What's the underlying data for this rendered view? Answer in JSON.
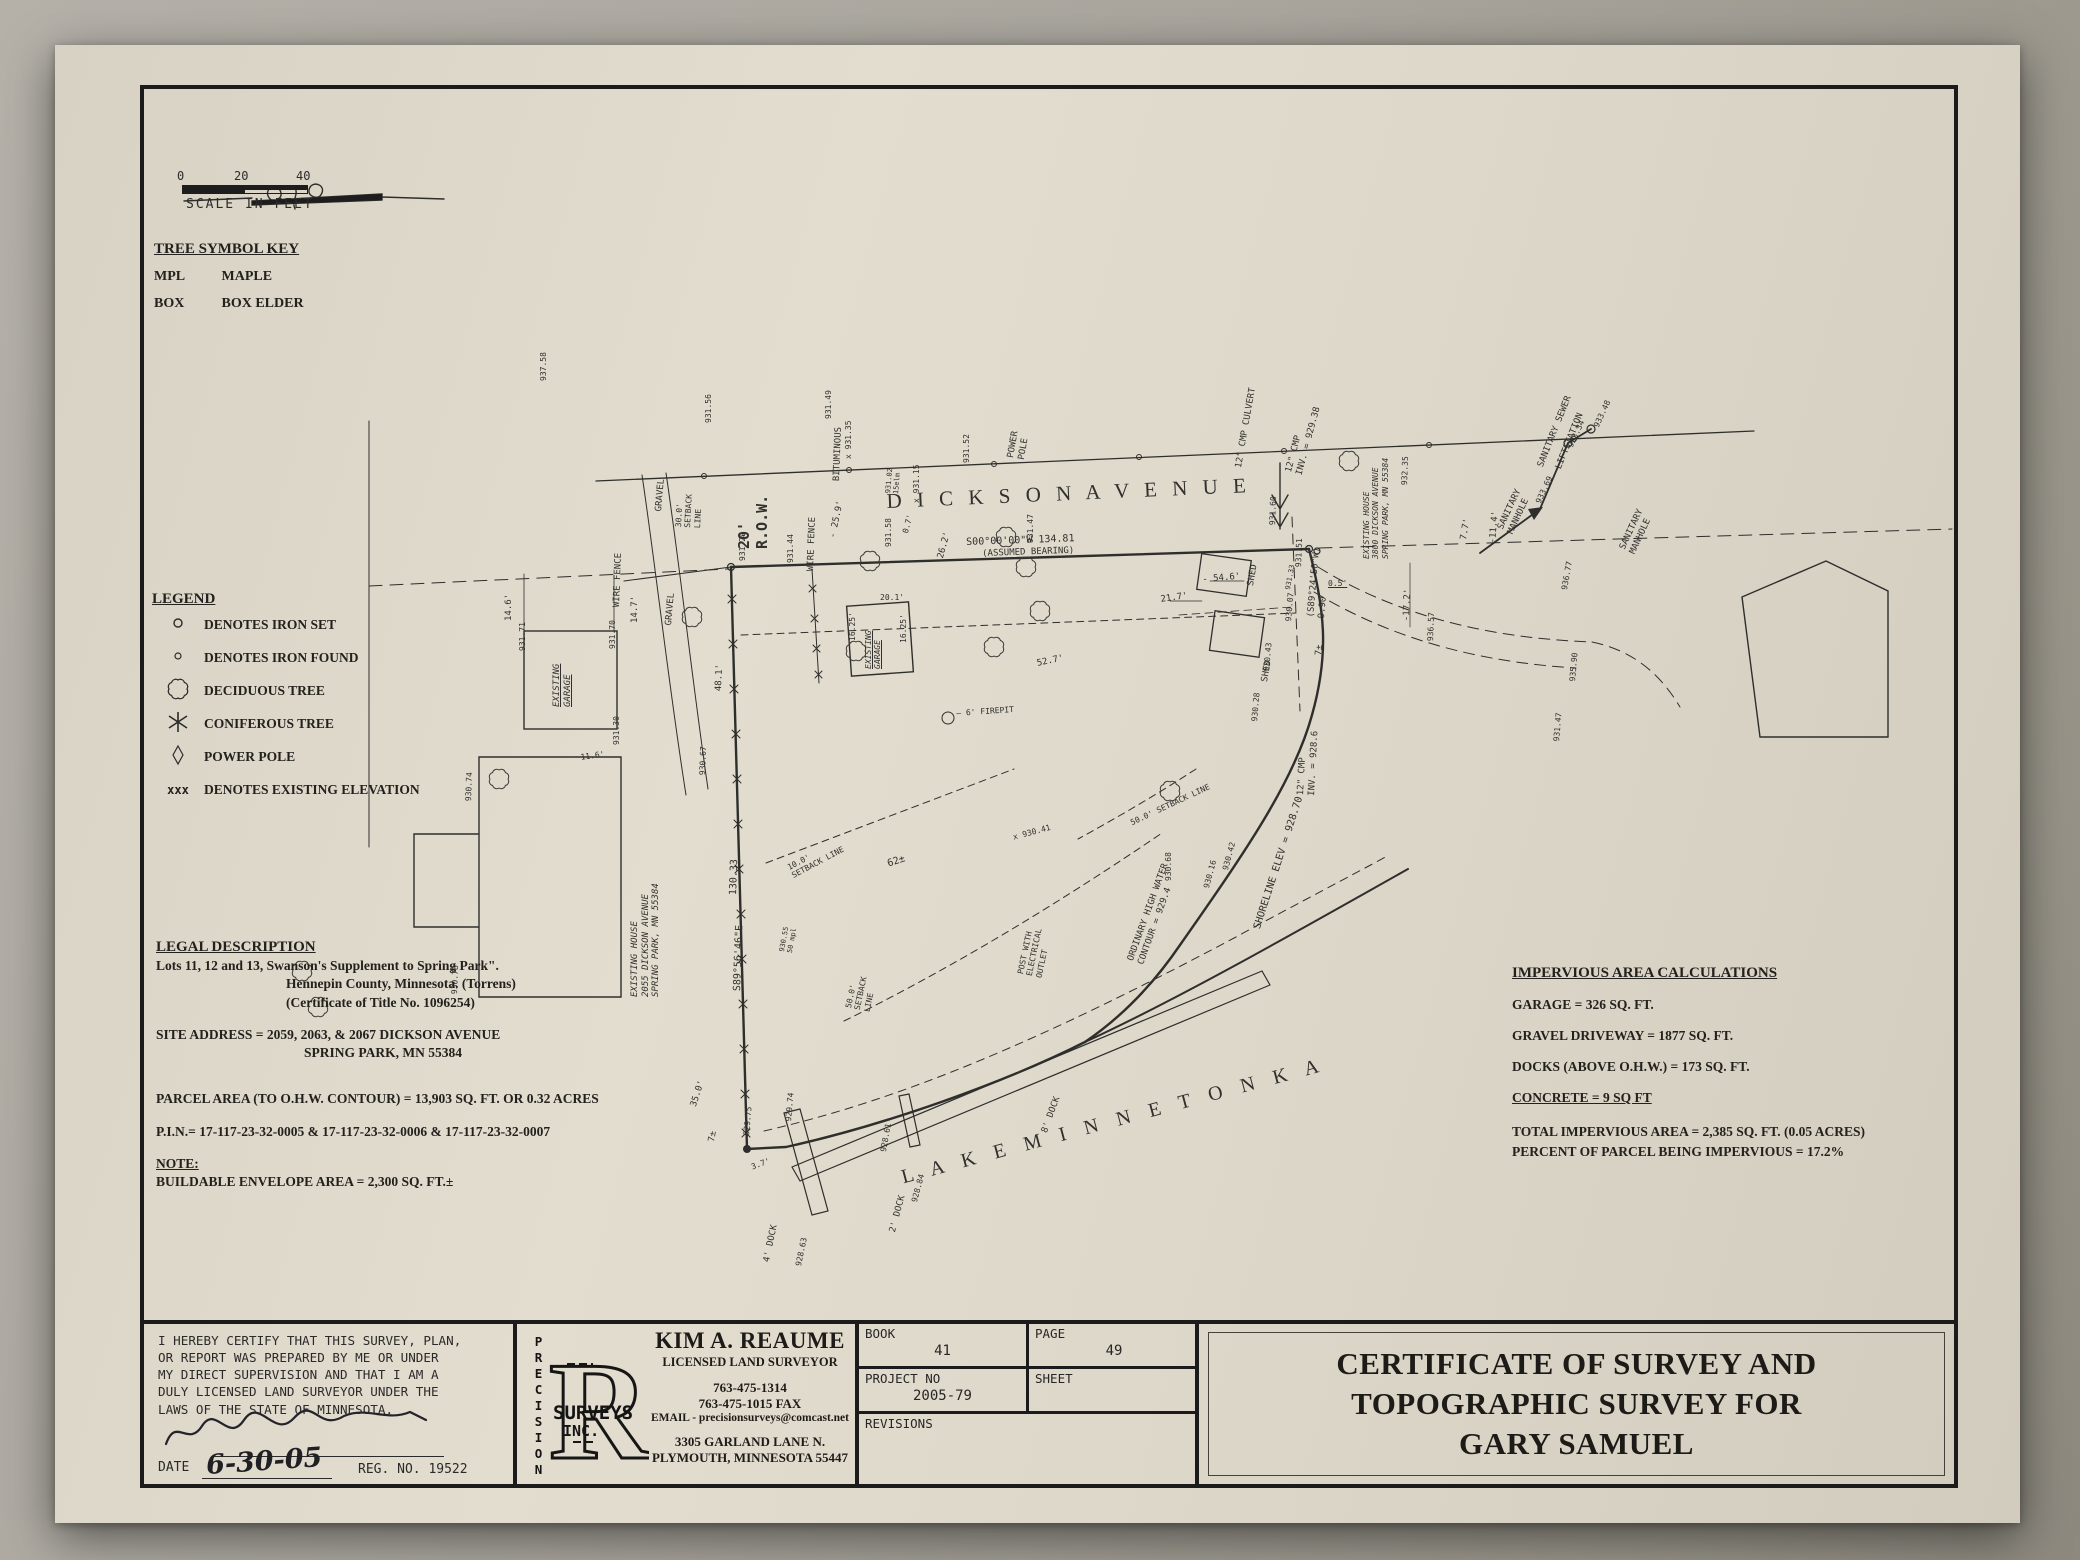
{
  "colors": {
    "paper": "#ded8ca",
    "ink": "#1f1f1f",
    "background": "#a39f97"
  },
  "scale_bar": {
    "tick_0": "0",
    "tick_20": "20",
    "tick_40": "40",
    "caption": "SCALE IN FEET"
  },
  "tree_key": {
    "title": "TREE SYMBOL KEY",
    "rows": [
      {
        "abbr": "MPL",
        "name": "MAPLE"
      },
      {
        "abbr": "BOX",
        "name": "BOX ELDER"
      }
    ]
  },
  "legend": {
    "title": "LEGEND",
    "items": [
      {
        "symbol": "iron-set-circle",
        "label": "DENOTES IRON SET"
      },
      {
        "symbol": "iron-found-circle",
        "label": "DENOTES IRON FOUND"
      },
      {
        "symbol": "deciduous-tree-cloud",
        "label": "DECIDUOUS TREE"
      },
      {
        "symbol": "coniferous-tree-star",
        "label": "CONIFEROUS TREE"
      },
      {
        "symbol": "power-pole-diamond",
        "label": "POWER POLE"
      },
      {
        "symbol": "xxx",
        "label": "DENOTES EXISTING ELEVATION"
      }
    ]
  },
  "legal": {
    "title": "LEGAL DESCRIPTION",
    "line1": "Lots 11, 12 and 13, Swanson's Supplement to Spring Park\".",
    "line2": "Hennepin County, Minnesota. (Torrens)",
    "line3": "(Certificate of Title No. 1096254)",
    "site1": "SITE ADDRESS =  2059, 2063, & 2067 DICKSON AVENUE",
    "site2": "SPRING PARK, MN 55384",
    "parcel": "PARCEL AREA (TO O.H.W. CONTOUR) = 13,903 SQ. FT. OR 0.32 ACRES",
    "pin": "P.I.N.= 17-117-23-32-0005 & 17-117-23-32-0006 & 17-117-23-32-0007",
    "note_title": "NOTE:",
    "note_body": "BUILDABLE ENVELOPE AREA = 2,300 SQ. FT.±"
  },
  "impervious": {
    "title": "IMPERVIOUS AREA CALCULATIONS",
    "garage": "GARAGE =  326 SQ. FT.",
    "gravel": "GRAVEL DRIVEWAY =  1877 SQ. FT.",
    "docks": "DOCKS (ABOVE O.H.W.)  =  173 SQ. FT.",
    "concrete": "CONCRETE = 9 SQ FT",
    "total": "TOTAL IMPERVIOUS AREA = 2,385 SQ. FT. (0.05 ACRES)",
    "percent": "PERCENT OF PARCEL BEING IMPERVIOUS = 17.2%"
  },
  "footer": {
    "certification": {
      "lines": [
        "I HEREBY CERTIFY THAT THIS SURVEY, PLAN,",
        "OR REPORT WAS PREPARED BY ME OR UNDER",
        "MY DIRECT SUPERVISION AND THAT I AM A",
        "DULY LICENSED LAND SURVEYOR UNDER THE",
        "LAWS OF THE STATE OF MINNESOTA."
      ],
      "date_label": "DATE",
      "date_value": "6-30-05",
      "reg": "REG. NO. 19522"
    },
    "logo": {
      "letter": "R",
      "vertical": "PRECISION",
      "word2": "SURVEYS",
      "word3": "INC."
    },
    "surveyor": {
      "name": "KIM A. REAUME",
      "title": "LICENSED LAND SURVEYOR",
      "phone": "763-475-1314",
      "fax": "763-475-1015 FAX",
      "email": "EMAIL - precisionsurveys@comcast.net",
      "addr1": "3305 GARLAND LANE N.",
      "addr2": "PLYMOUTH, MINNESOTA 55447"
    },
    "grid": {
      "book_label": "BOOK",
      "book": "41",
      "page_label": "PAGE",
      "page": "49",
      "project_label": "PROJECT NO",
      "project": "2005-79",
      "sheet_label": "SHEET",
      "sheet": "",
      "revisions_label": "REVISIONS"
    },
    "title_block": {
      "line1": "CERTIFICATE OF SURVEY AND",
      "line2": "TOPOGRAPHIC SURVEY FOR",
      "line3": "GARY SAMUEL"
    }
  },
  "map": {
    "labels": [
      {
        "t": "D I C K S O N   A V E N U E",
        "x": 742,
        "y": 400,
        "r": -2.5,
        "fs": 21,
        "sr": 1,
        "ls": 5,
        "n": "street-name-dickson-avenue"
      },
      {
        "t": "L A K E   M I N N E T O N K A",
        "x": 755,
        "y": 1078,
        "r": -15,
        "fs": 20,
        "sr": 1,
        "ls": 7,
        "n": "lake-name-minnetonka"
      },
      {
        "t": "20'\nR.O.W.",
        "x": 592,
        "y": 460,
        "r": -90,
        "fs": 15,
        "w": 1,
        "n": "row-label"
      },
      {
        "t": "S00°00'00\"W    134.81",
        "x": 822,
        "y": 448,
        "r": -2,
        "fs": 10,
        "n": "bearing-north-line"
      },
      {
        "t": "(ASSUMED BEARING)",
        "x": 838,
        "y": 460,
        "r": -2,
        "fs": 9
      },
      {
        "t": "BITUMINOUS",
        "x": 688,
        "y": 392,
        "r": -88,
        "fs": 9
      },
      {
        "t": "POWER\nPOLE",
        "x": 862,
        "y": 368,
        "r": -80,
        "fs": 9
      },
      {
        "t": "12\" CMP CULVERT",
        "x": 1090,
        "y": 378,
        "r": -80,
        "fs": 9
      },
      {
        "t": "12\" CMP\nINV. = 929.38",
        "x": 1140,
        "y": 382,
        "r": -75,
        "fs": 9
      },
      {
        "t": "932.35",
        "x": 1256,
        "y": 396,
        "r": -88,
        "fs": 8
      },
      {
        "t": "931.60",
        "x": 1124,
        "y": 436,
        "r": -88,
        "fs": 8
      },
      {
        "t": "931.51",
        "x": 1150,
        "y": 478,
        "r": -88,
        "fs": 8
      },
      {
        "t": "(S89°24'50\"W)\n9.90",
        "x": 1162,
        "y": 528,
        "r": -85,
        "fs": 9,
        "n": "bearing-east-corner"
      },
      {
        "t": "0.5'",
        "x": 1184,
        "y": 490,
        "fs": 8,
        "u": 1
      },
      {
        "t": "931.33",
        "x": 1140,
        "y": 500,
        "r": -80,
        "fs": 7
      },
      {
        "t": "7±",
        "x": 1170,
        "y": 566,
        "r": -85,
        "fs": 9
      },
      {
        "t": "12\" CMP\nINV. = 928.6",
        "x": 1152,
        "y": 706,
        "r": -87,
        "fs": 9
      },
      {
        "t": "930.07",
        "x": 1140,
        "y": 532,
        "r": -85,
        "fs": 8
      },
      {
        "t": "930.43",
        "x": 1118,
        "y": 582,
        "r": -85,
        "fs": 8
      },
      {
        "t": "930.28",
        "x": 1106,
        "y": 632,
        "r": -85,
        "fs": 8
      },
      {
        "t": "SANITARY\nMANHOLE",
        "x": 1352,
        "y": 438,
        "r": -65,
        "fs": 9
      },
      {
        "t": "SANITARY SEWER",
        "x": 1392,
        "y": 376,
        "r": -68,
        "fs": 9
      },
      {
        "t": "LIFTSTATION",
        "x": 1410,
        "y": 378,
        "r": -68,
        "fs": 9
      },
      {
        "t": "SANITARY\nMANHOLE",
        "x": 1474,
        "y": 458,
        "r": -65,
        "fs": 9
      },
      {
        "t": "933.69",
        "x": 1390,
        "y": 412,
        "r": -65,
        "fs": 8
      },
      {
        "t": "933.34",
        "x": 1422,
        "y": 356,
        "r": -65,
        "fs": 8
      },
      {
        "t": "933.48",
        "x": 1448,
        "y": 336,
        "r": -65,
        "fs": 8
      },
      {
        "t": "S89°56'46\"E",
        "x": 588,
        "y": 902,
        "r": -88,
        "fs": 10,
        "n": "bearing-west-line"
      },
      {
        "t": "130.33",
        "x": 584,
        "y": 806,
        "r": -88,
        "fs": 10
      },
      {
        "t": "EXISTING\nGARAGE",
        "x": 408,
        "y": 618,
        "r": -90,
        "fs": 9,
        "u": 1,
        "it": 1,
        "n": "existing-garage-label"
      },
      {
        "t": "14.6'",
        "x": 360,
        "y": 532,
        "r": -90,
        "fs": 9
      },
      {
        "t": "14.7'",
        "x": 486,
        "y": 534,
        "r": -90,
        "fs": 9
      },
      {
        "t": "931.71",
        "x": 374,
        "y": 562,
        "r": -90,
        "fs": 8
      },
      {
        "t": "931.70",
        "x": 464,
        "y": 560,
        "r": -90,
        "fs": 8
      },
      {
        "t": "931.30",
        "x": 468,
        "y": 656,
        "r": -90,
        "fs": 8
      },
      {
        "t": "EXISTING HOUSE\n2055 DICKSON AVENUE\nSPRING PARK, MN 55384",
        "x": 486,
        "y": 908,
        "r": -90,
        "fs": 9,
        "it": 1,
        "n": "existing-house-2055-label"
      },
      {
        "t": "48.1'",
        "x": 570,
        "y": 602,
        "r": -88,
        "fs": 9
      },
      {
        "t": "GRAVEL",
        "x": 510,
        "y": 422,
        "r": -85,
        "fs": 9
      },
      {
        "t": "30.0'\nSETBACK\nLINE",
        "x": 530,
        "y": 438,
        "r": -87,
        "fs": 8
      },
      {
        "t": "WIRE FENCE",
        "x": 468,
        "y": 518,
        "r": -88,
        "fs": 9
      },
      {
        "t": "WIRE FENCE",
        "x": 662,
        "y": 482,
        "r": -88,
        "fs": 9
      },
      {
        "t": "GRAVEL",
        "x": 520,
        "y": 536,
        "r": -85,
        "fs": 9
      },
      {
        "t": "- 25.9'",
        "x": 684,
        "y": 448,
        "r": -78,
        "fs": 9
      },
      {
        "t": "0.7'",
        "x": 757,
        "y": 443,
        "r": -75,
        "fs": 8
      },
      {
        "t": "26.2'",
        "x": 792,
        "y": 468,
        "r": -75,
        "fs": 9
      },
      {
        "t": "20.1'",
        "x": 736,
        "y": 504,
        "fs": 8
      },
      {
        "t": "16.25'",
        "x": 704,
        "y": 552,
        "r": -90,
        "fs": 8
      },
      {
        "t": "16.25'",
        "x": 755,
        "y": 554,
        "r": -90,
        "fs": 8
      },
      {
        "t": "EXISTING\nGARAGE",
        "x": 720,
        "y": 580,
        "r": -90,
        "fs": 8,
        "u": 1,
        "it": 1,
        "n": "existing-garage-2-label"
      },
      {
        "t": "52.7'",
        "x": 892,
        "y": 570,
        "r": -12,
        "fs": 9
      },
      {
        "t": "50.0'\nSETBACK\nLINE",
        "x": 700,
        "y": 918,
        "r": -78,
        "fs": 8
      },
      {
        "t": "50.0' SETBACK LINE",
        "x": 985,
        "y": 730,
        "r": -25,
        "fs": 8
      },
      {
        "t": "10.0'\nSETBACK LINE",
        "x": 642,
        "y": 775,
        "r": -28,
        "fs": 8
      },
      {
        "t": "62±",
        "x": 742,
        "y": 770,
        "r": -18,
        "fs": 10
      },
      {
        "t": "— 6' FIREPIT",
        "x": 812,
        "y": 620,
        "r": -4,
        "fs": 8,
        "n": "firepit-label"
      },
      {
        "t": "POST WITH\nELECTRICAL\nOUTLET",
        "x": 872,
        "y": 884,
        "r": -78,
        "fs": 8
      },
      {
        "t": "930.55\n50 mpl",
        "x": 634,
        "y": 862,
        "r": -80,
        "fs": 7
      },
      {
        "t": "ORDINARY HIGH WATER\nCONTOUR = 929.4",
        "x": 982,
        "y": 870,
        "r": -70,
        "fs": 9,
        "n": "ohw-contour-label"
      },
      {
        "t": "SHORELINE ELEV = 928.70",
        "x": 1108,
        "y": 838,
        "r": -72,
        "fs": 10,
        "n": "shoreline-elev-label"
      },
      {
        "t": "4' DOCK",
        "x": 618,
        "y": 1172,
        "r": -78,
        "fs": 9
      },
      {
        "t": "928.63",
        "x": 650,
        "y": 1176,
        "r": -78,
        "fs": 8
      },
      {
        "t": "2' DOCK",
        "x": 744,
        "y": 1142,
        "r": -75,
        "fs": 9
      },
      {
        "t": "928.84",
        "x": 766,
        "y": 1112,
        "r": -75,
        "fs": 8
      },
      {
        "t": "8' DOCK",
        "x": 896,
        "y": 1042,
        "r": -70,
        "fs": 9
      },
      {
        "t": "3.7'",
        "x": 606,
        "y": 1074,
        "r": -20,
        "fs": 8
      },
      {
        "t": "929.74",
        "x": 640,
        "y": 1032,
        "r": -85,
        "fs": 8
      },
      {
        "t": "928.61",
        "x": 735,
        "y": 1062,
        "r": -80,
        "fs": 8
      },
      {
        "t": "930.16",
        "x": 1058,
        "y": 798,
        "r": -75,
        "fs": 8
      },
      {
        "t": "930.42",
        "x": 1077,
        "y": 780,
        "r": -75,
        "fs": 8
      },
      {
        "t": "930.68",
        "x": 1020,
        "y": 792,
        "r": -90,
        "fs": 8
      },
      {
        "t": "x 930.41",
        "x": 868,
        "y": 744,
        "r": -15,
        "fs": 8
      },
      {
        "t": "35.0'",
        "x": 545,
        "y": 1016,
        "r": -72,
        "fs": 9
      },
      {
        "t": "11.6'",
        "x": 436,
        "y": 664,
        "r": -8,
        "fs": 8
      },
      {
        "t": "7±",
        "x": 563,
        "y": 1052,
        "r": -80,
        "fs": 9
      },
      {
        "t": "929.75",
        "x": 598,
        "y": 1046,
        "r": -85,
        "fs": 8
      },
      {
        "t": "930.74",
        "x": 320,
        "y": 712,
        "r": -88,
        "fs": 8
      },
      {
        "t": "930.78",
        "x": 306,
        "y": 905,
        "r": -88,
        "fs": 8
      },
      {
        "t": "930.67",
        "x": 554,
        "y": 686,
        "r": -88,
        "fs": 8
      },
      {
        "t": "EXISTING HOUSE\n3800 DICKSON AVENUE\nSPRING PARK, MN 55384",
        "x": 1218,
        "y": 470,
        "r": -90,
        "fs": 8,
        "it": 1,
        "n": "existing-house-3800-label"
      },
      {
        "t": "SHED",
        "x": 1102,
        "y": 496,
        "r": -80,
        "fs": 9,
        "n": "shed-label"
      },
      {
        "t": "SHED",
        "x": 1116,
        "y": 592,
        "r": -80,
        "fs": 9,
        "n": "shed-label"
      },
      {
        "t": "- 54.6'",
        "x": 1058,
        "y": 486,
        "r": -5,
        "fs": 9
      },
      {
        "t": "21.7'",
        "x": 1016,
        "y": 506,
        "r": -8,
        "fs": 9
      },
      {
        "t": "-17.2'",
        "x": 1258,
        "y": 532,
        "r": -88,
        "fs": 9
      },
      {
        "t": "936.57",
        "x": 1282,
        "y": 552,
        "r": -88,
        "fs": 8
      },
      {
        "t": "936.77",
        "x": 1416,
        "y": 500,
        "r": -80,
        "fs": 8
      },
      {
        "t": "935.90",
        "x": 1424,
        "y": 592,
        "r": -85,
        "fs": 8
      },
      {
        "t": "931.47",
        "x": 1408,
        "y": 652,
        "r": -85,
        "fs": 8
      },
      {
        "t": "7.7'",
        "x": 1315,
        "y": 450,
        "r": -80,
        "fs": 9
      },
      {
        "t": "-11.4'",
        "x": 1344,
        "y": 454,
        "r": -85,
        "fs": 9
      },
      {
        "t": "931.56",
        "x": 560,
        "y": 334,
        "r": -90,
        "fs": 8
      },
      {
        "t": "937.58",
        "x": 395,
        "y": 292,
        "r": -90,
        "fs": 8
      },
      {
        "t": "931.49",
        "x": 680,
        "y": 330,
        "r": -90,
        "fs": 8
      },
      {
        "t": "931.58",
        "x": 740,
        "y": 458,
        "r": -90,
        "fs": 8
      },
      {
        "t": "931.29",
        "x": 594,
        "y": 472,
        "r": -90,
        "fs": 8
      },
      {
        "t": "931.44",
        "x": 642,
        "y": 474,
        "r": -90,
        "fs": 8
      },
      {
        "t": "931.47",
        "x": 882,
        "y": 454,
        "r": -90,
        "fs": 8
      },
      {
        "t": "x 931.15",
        "x": 768,
        "y": 414,
        "r": -90,
        "fs": 8
      },
      {
        "t": "931.52",
        "x": 818,
        "y": 374,
        "r": -90,
        "fs": 8
      },
      {
        "t": "931.02\n15elm",
        "x": 740,
        "y": 404,
        "r": -85,
        "fs": 7
      },
      {
        "t": "x 931.35",
        "x": 700,
        "y": 370,
        "r": -90,
        "fs": 8
      }
    ]
  }
}
